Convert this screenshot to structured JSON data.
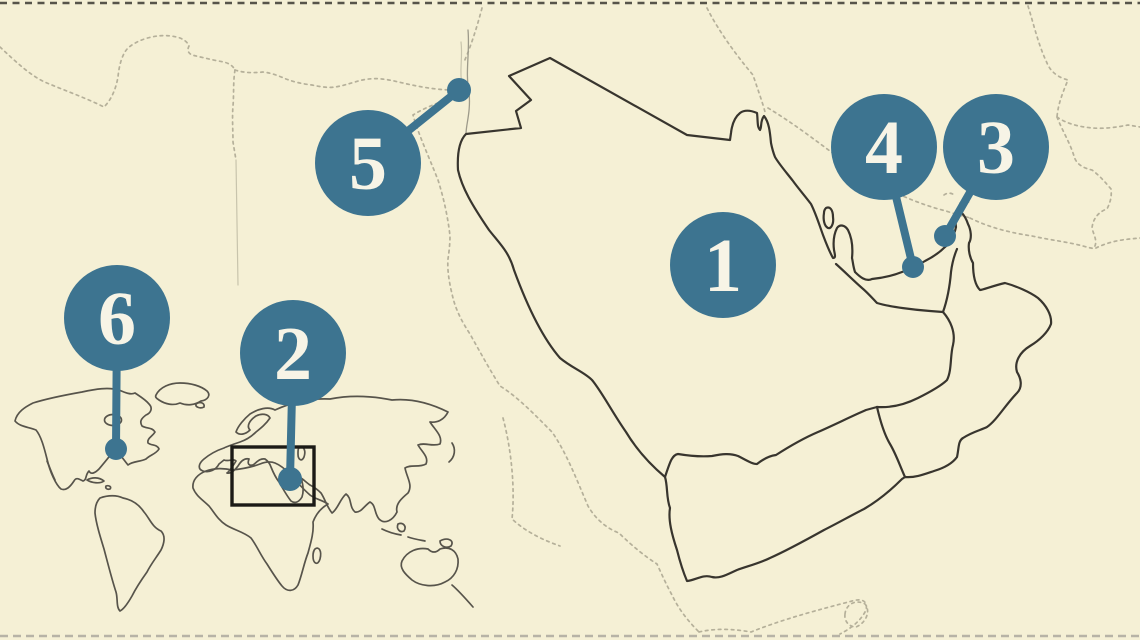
{
  "page": {
    "kind": "outline-map-quiz",
    "width": 1140,
    "height": 640
  },
  "palette": {
    "bg": "#f5f0d5",
    "outline": "#38352e",
    "dotted": "#b5b09a",
    "faint": "#9d9a8a",
    "faint2": "#c8c4ac",
    "inset": "#57544b",
    "box": "#1b1a16",
    "teal": "#3d7490",
    "label": "#f7f4e6",
    "edge_top": "#57544a",
    "edge_bottom": "#b7b3a6"
  },
  "map": {
    "markers": [
      {
        "label": "1",
        "x": 723,
        "y": 265,
        "r": 53,
        "dot": null
      },
      {
        "label": "2",
        "x": 293,
        "y": 353,
        "r": 53,
        "dot": {
          "x": 290,
          "y": 479,
          "r": 12
        }
      },
      {
        "label": "3",
        "x": 996,
        "y": 147,
        "r": 53,
        "dot": {
          "x": 945,
          "y": 236,
          "r": 11
        }
      },
      {
        "label": "4",
        "x": 884,
        "y": 147,
        "r": 53,
        "dot": {
          "x": 913,
          "y": 267,
          "r": 11
        }
      },
      {
        "label": "5",
        "x": 368,
        "y": 163,
        "r": 53,
        "dot": {
          "x": 459,
          "y": 90,
          "r": 12
        }
      },
      {
        "label": "6",
        "x": 117,
        "y": 318,
        "r": 53,
        "dot": {
          "x": 116,
          "y": 449,
          "r": 11
        }
      }
    ],
    "inset_box": {
      "x": 232,
      "y": 447,
      "width": 82,
      "height": 58
    }
  }
}
